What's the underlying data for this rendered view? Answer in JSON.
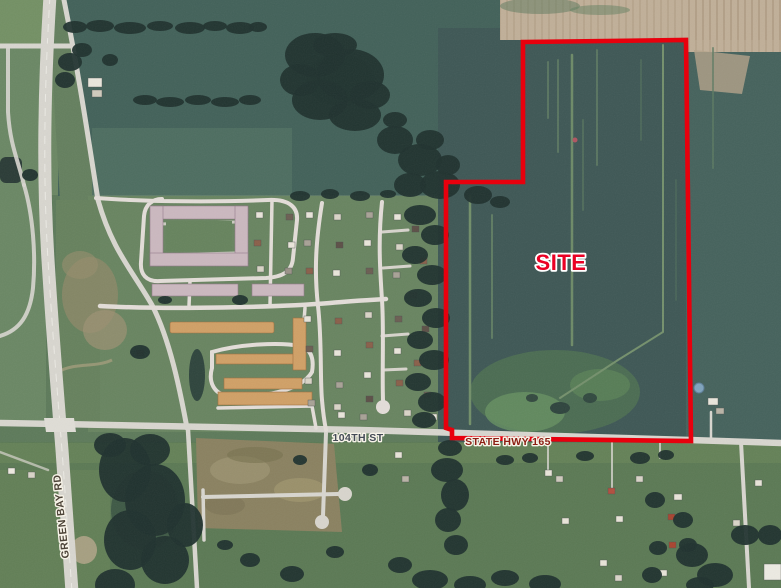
{
  "map_annotations": {
    "site_label": "SITE",
    "road_104th": "104TH ST",
    "road_hwy165": "STATE HWY 165",
    "road_green_bay": "GREEN BAY RD"
  },
  "site_boundary": {
    "points": "523,42 686,40 691,441 452,438 452,430 446,428 446,182 523,182",
    "stroke_color": "#e8000d",
    "stroke_width": "4.6"
  },
  "label_styles": {
    "site_fill": "#ea0024",
    "road_104th_fill": "#434a56",
    "hwy165_fill": "#8c1d12",
    "green_bay_fill": "#4c4337",
    "halo": "#f7f3e8"
  },
  "terrain_colors": {
    "crop_field_dark": "#3e5755",
    "field_teal": "#426159",
    "grass": "#688460",
    "harvested_tan": "#c0af98",
    "dirt_development": "#8a8160",
    "trees": "#20322e",
    "road": "#d8d6cf",
    "pond": "#7fa3bd"
  }
}
